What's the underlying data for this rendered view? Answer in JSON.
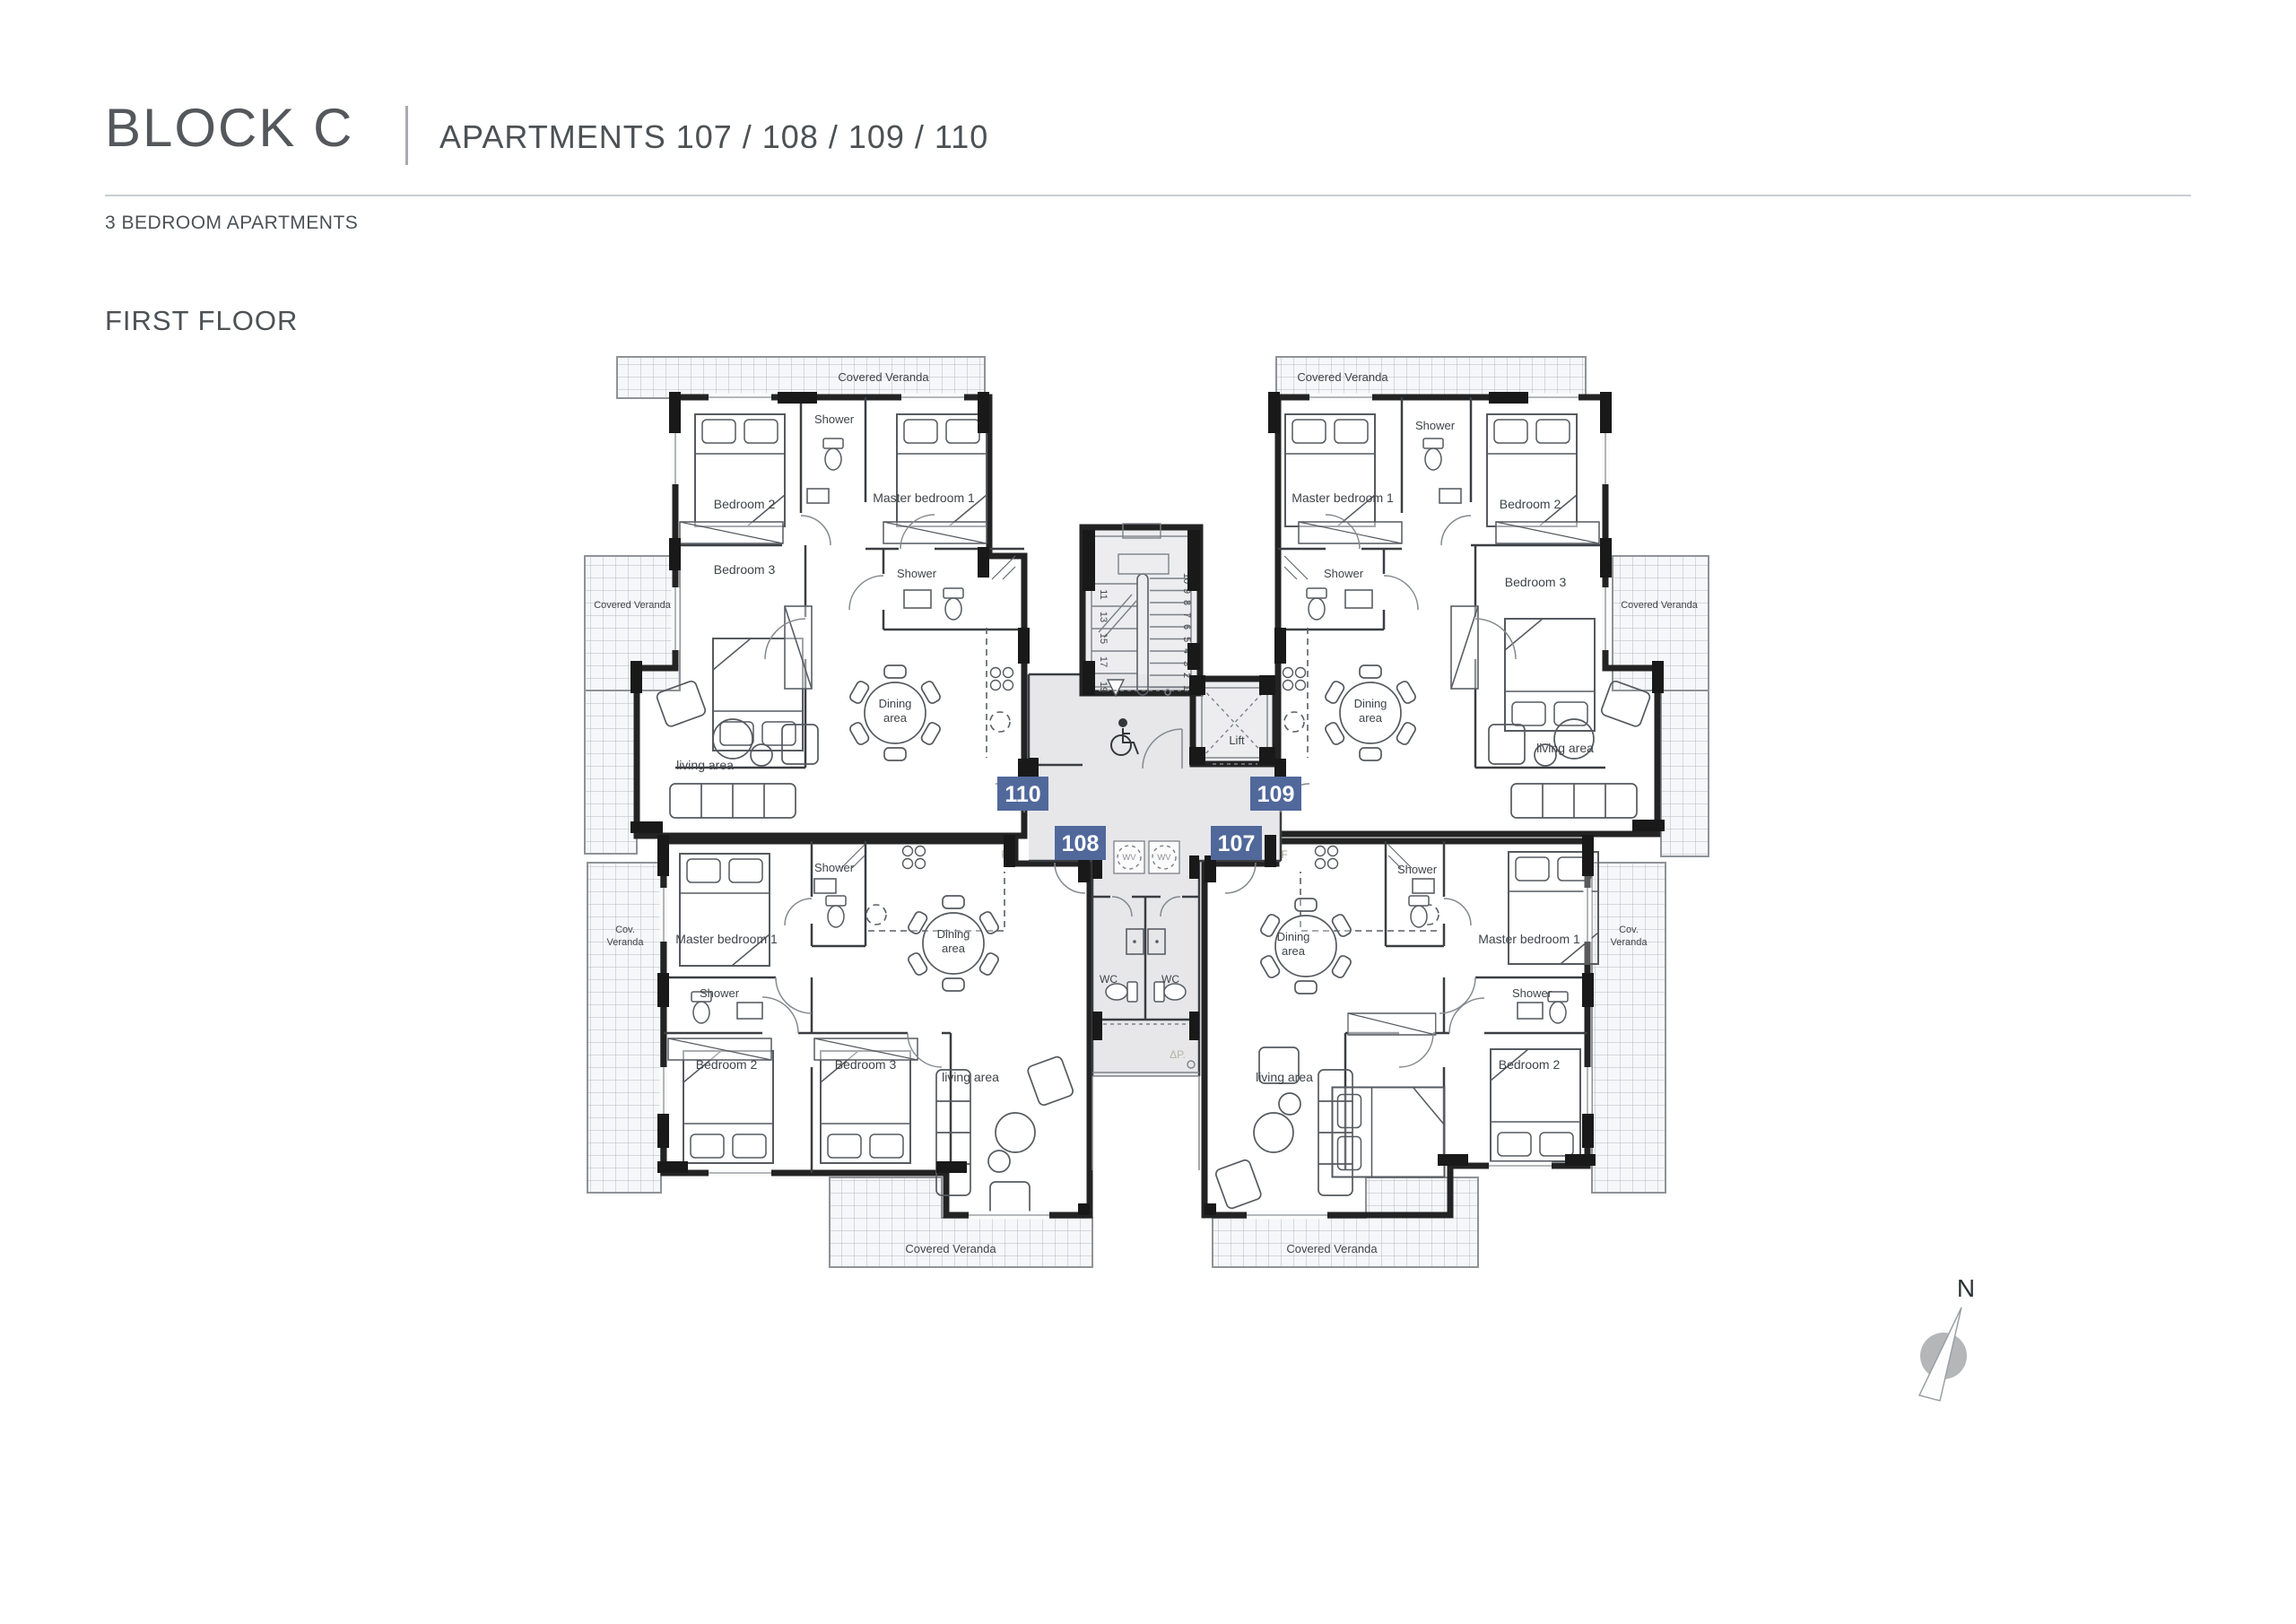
{
  "header": {
    "block_title": "BLOCK C",
    "apartments_subtitle": "APARTMENTS 107 / 108 / 109 / 110",
    "category_label": "3 BEDROOM APARTMENTS",
    "floor_label": "FIRST FLOOR"
  },
  "colors": {
    "badge_bg": "#51689b",
    "apt110_fill": "#f6efdb",
    "apt109_fill": "#f8dce3",
    "apt108_fill": "#cfe1f0",
    "apt107_fill": "#f4f1bd"
  },
  "plan": {
    "apt110": {
      "badge": "110",
      "veranda_top": "Covered Veranda",
      "veranda_side": "Covered Veranda",
      "bedroom2": "Bedroom 2",
      "shower_top": "Shower",
      "master": "Master bedroom 1",
      "bedroom3": "Bedroom 3",
      "shower_mid": "Shower",
      "dining1": "Dining",
      "dining2": "area",
      "living": "living area"
    },
    "apt109": {
      "badge": "109",
      "veranda_top": "Covered Veranda",
      "veranda_side": "Covered Veranda",
      "master": "Master bedroom 1",
      "shower_top": "Shower",
      "bedroom2": "Bedroom 2",
      "shower_mid": "Shower",
      "bedroom3": "Bedroom 3",
      "dining1": "Dining",
      "dining2": "area",
      "living": "living area"
    },
    "apt108": {
      "badge": "108",
      "master": "Master bedroom 1",
      "shower_top": "Shower",
      "dining1": "Dining",
      "dining2": "area",
      "veranda_side1": "Cov.",
      "veranda_side2": "Veranda",
      "shower_mid": "Shower",
      "bedroom2": "Bedroom 2",
      "bedroom3": "Bedroom 3",
      "living": "living area",
      "veranda_bottom": "Covered Veranda",
      "fridge": "F"
    },
    "apt107": {
      "badge": "107",
      "dining1": "Dining",
      "dining2": "area",
      "shower_top": "Shower",
      "master": "Master bedroom 1",
      "veranda_side1": "Cov.",
      "veranda_side2": "Veranda",
      "shower_mid": "Shower",
      "living": "living area",
      "bedroom2": "Bedroom 2",
      "veranda_bottom": "Covered Veranda",
      "fridge": "F"
    },
    "common": {
      "lift": "Lift",
      "wc_left": "WC",
      "wc_right": "WC",
      "wv_left": "WV",
      "wv_right": "WV",
      "dp": "ΔP.",
      "stairs_right": [
        "1",
        "2",
        "3",
        "4",
        "5",
        "6",
        "7",
        "8",
        "9",
        "10"
      ],
      "stairs_left": [
        "11",
        "13",
        "15",
        "17",
        "19"
      ]
    },
    "compass_n": "N"
  }
}
